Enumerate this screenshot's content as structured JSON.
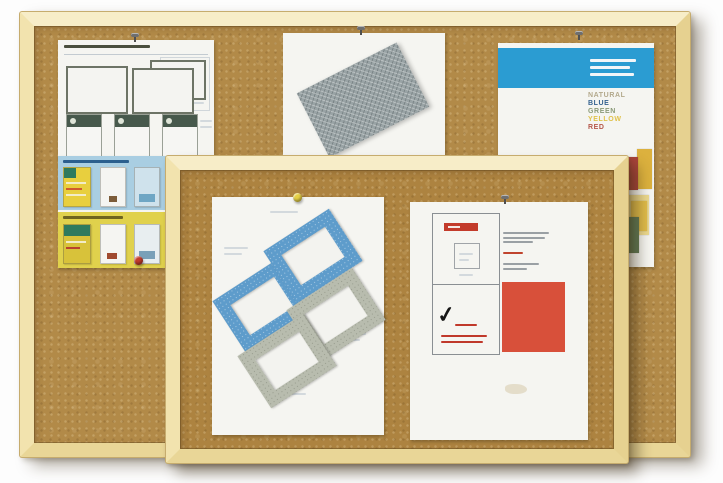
{
  "meta": {
    "description": "Product photograph of two overlapping wood-framed cork bulletin boards with printed sheets pinned to them",
    "board_count": "2",
    "checkmark_glyph": "✓"
  },
  "palette": {
    "background": "#fdfdfd",
    "cork_back": "#b28a48",
    "cork_front": "#ad8340",
    "frame_wood": "#f0e2ac",
    "frame_edge": "#c6ac6e"
  },
  "back_board": {
    "papers": {
      "spec_sheet": {
        "name": "printed spec sheet with two board outline diagrams, sidebar table and three green-header cards"
      },
      "flyer_sheet": {
        "name": "flyer with light-blue and yellow bands of brochure thumbnails",
        "blue_band_color": "#a9cee2",
        "yellow_band_color": "#e0d14c"
      },
      "swatch_sheet": {
        "name": "sheet with rotated grey mesh fabric swatch",
        "swatch_color": "#99a3a5"
      },
      "color_sheet": {
        "name": "colour range sheet",
        "header_color": "#2b9cd2",
        "color_words": [
          {
            "label": "NATURAL",
            "color": "#b3a98c"
          },
          {
            "label": "BLUE",
            "color": "#33618f"
          },
          {
            "label": "GREEN",
            "color": "#8a9a78"
          },
          {
            "label": "YELLOW",
            "color": "#e0c24c"
          },
          {
            "label": "RED",
            "color": "#b5574a"
          }
        ],
        "chip_colors": [
          "#a8433a",
          "#dcb13e",
          "#ecd98e",
          "#e0bc4a",
          "#5f7a55"
        ]
      }
    }
  },
  "front_board": {
    "papers": {
      "frames_sheet": {
        "name": "sheet showing four rotated frame corner swatches",
        "blue_frame_color": "#5e9ccb",
        "gray_frame_color": "#b8bcae"
      },
      "grid_sheet": {
        "name": "sheet with 2x2 grid diagram, tick mark and red square",
        "checkmark": "✓",
        "square_color": "#d8503a",
        "label_color": "#c33b2b"
      }
    }
  },
  "pins": {
    "metal": "#6e6e6e",
    "yellow": "#e6d044",
    "red": "#c23c2c"
  }
}
